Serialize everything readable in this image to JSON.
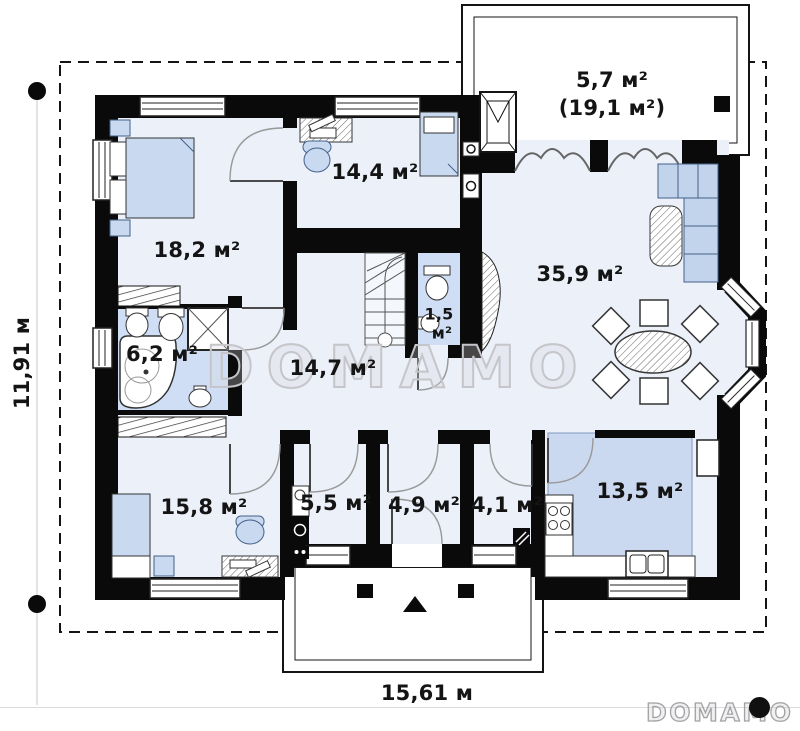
{
  "plan": {
    "rooms": [
      {
        "name": "terrace",
        "area": "5,7 м²",
        "area_total": "(19,1 м²)"
      },
      {
        "name": "bedroom-top",
        "area": "18,2 м²"
      },
      {
        "name": "study",
        "area": "14,4 м²"
      },
      {
        "name": "living-room",
        "area": "35,9 м²"
      },
      {
        "name": "hall",
        "area": "14,7 м²"
      },
      {
        "name": "wc",
        "area_value": "1,5",
        "area_unit": "м²"
      },
      {
        "name": "bathroom",
        "area": "6,2 м²"
      },
      {
        "name": "bedroom-bottom",
        "area": "15,8 м²"
      },
      {
        "name": "utility",
        "area": "5,5 м²"
      },
      {
        "name": "entry",
        "area": "4,9 м²"
      },
      {
        "name": "pantry",
        "area": "4,1 м²"
      },
      {
        "name": "kitchen",
        "area": "13,5 м²"
      }
    ],
    "dimensions": {
      "height": "11,91 м",
      "width": "15,61 м"
    },
    "watermark": {
      "center": "DOMAMO",
      "logo": "DOMAMO"
    },
    "colors": {
      "wall": "#0a0a0a",
      "room_fill": "#ebf0f9",
      "furniture_fill": "#c9d9ef",
      "kitchen_highlight": "#cbd9f0",
      "watermark": "#c6c6ca"
    }
  }
}
